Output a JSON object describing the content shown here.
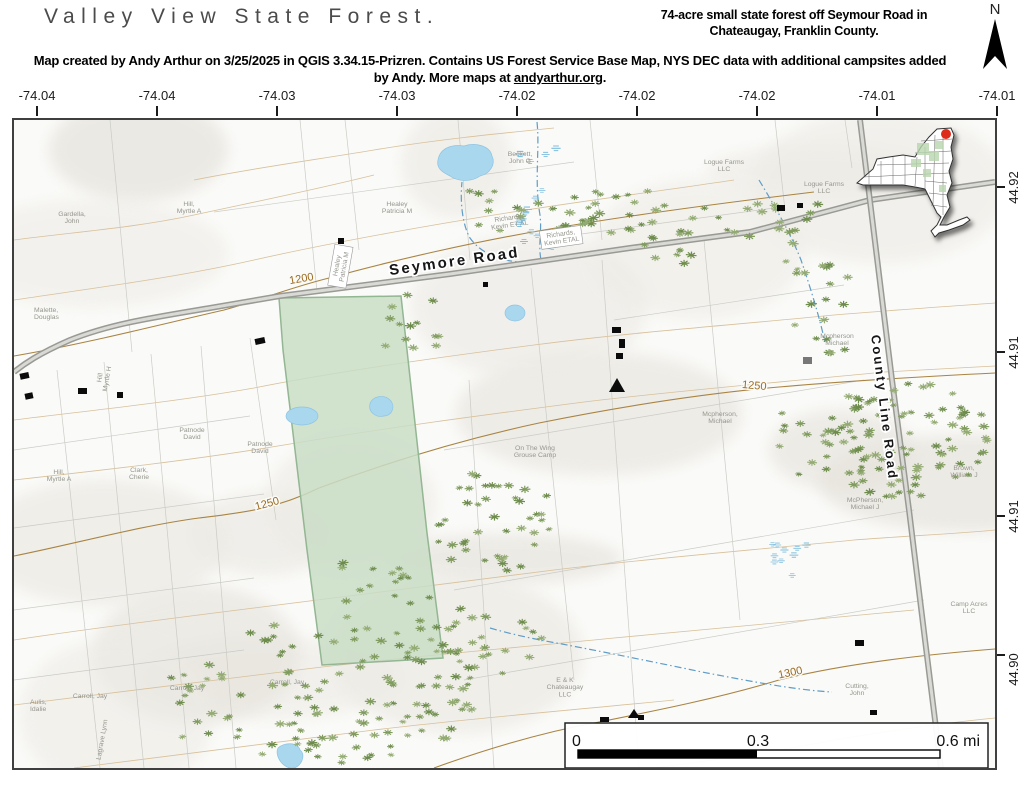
{
  "header": {
    "title": "Valley View State Forest.",
    "subtitle": "74-acre small state forest off Seymour Road in Chateaugay, Franklin County.",
    "credit_before": "Map created by Andy Arthur on 3/25/2025 in QGIS 3.34.15-Prizren. Contains US Forest Service Base Map, NYS DEC data with additional campsites added by Andy. More maps at ",
    "credit_link": "andyarthur.org",
    "credit_after": ".",
    "north_label": "N"
  },
  "axes": {
    "top": [
      "-74.04",
      "-74.04",
      "-74.03",
      "-74.03",
      "-74.02",
      "-74.02",
      "-74.02",
      "-74.01",
      "-74.01"
    ],
    "right": [
      "44.92",
      "44.91",
      "44.91",
      "44.90"
    ]
  },
  "map": {
    "road_labels": [
      {
        "text": "Seymore Road",
        "x": 441,
        "y": 146,
        "rotate": -8,
        "size": 15
      },
      {
        "text": "County Line Road",
        "x": 866,
        "y": 288,
        "rotate": 83,
        "size": 13
      }
    ],
    "contour_labels": [
      {
        "text": "1200",
        "x": 288,
        "y": 162,
        "rotate": -10
      },
      {
        "text": "1250",
        "x": 254,
        "y": 387,
        "rotate": -15
      },
      {
        "text": "1250",
        "x": 740,
        "y": 269,
        "rotate": 5
      },
      {
        "text": "1300",
        "x": 777,
        "y": 556,
        "rotate": -12
      }
    ],
    "owner_labels": [
      {
        "lines": [
          "Gardella,",
          "John"
        ],
        "x": 58,
        "y": 96
      },
      {
        "lines": [
          "Hill,",
          "Myrtle A"
        ],
        "x": 175,
        "y": 86
      },
      {
        "lines": [
          "Malette,",
          "Douglas"
        ],
        "x": 20,
        "y": 192,
        "anchor": "start"
      },
      {
        "lines": [
          "Healey",
          "Patricia M"
        ],
        "x": 383,
        "y": 86
      },
      {
        "lines": [
          "Healey",
          "Patricia M"
        ],
        "x": 325,
        "y": 146,
        "rotate": -80,
        "boxed": true
      },
      {
        "lines": [
          "Beckett,",
          "John G"
        ],
        "x": 506,
        "y": 36
      },
      {
        "lines": [
          "Logue Farms",
          "LLC"
        ],
        "x": 710,
        "y": 44
      },
      {
        "lines": [
          "Logue Farms",
          "LLC"
        ],
        "x": 810,
        "y": 66
      },
      {
        "lines": [
          "Richards,",
          "Kevin ET AL"
        ],
        "x": 495,
        "y": 100,
        "rotate": -8
      },
      {
        "lines": [
          "Richards,",
          "Kevin ETAL"
        ],
        "x": 547,
        "y": 116,
        "rotate": -8,
        "boxed": true
      },
      {
        "lines": [
          "Mcpherson",
          "Michael"
        ],
        "x": 823,
        "y": 218
      },
      {
        "lines": [
          "Mcpherson,",
          "Michael"
        ],
        "x": 706,
        "y": 296
      },
      {
        "lines": [
          "McPherson,",
          "Michael J"
        ],
        "x": 851,
        "y": 382
      },
      {
        "lines": [
          "Brown,",
          "William J"
        ],
        "x": 950,
        "y": 350
      },
      {
        "lines": [
          "Patnode",
          "David"
        ],
        "x": 178,
        "y": 312
      },
      {
        "lines": [
          "Patnode",
          "David"
        ],
        "x": 246,
        "y": 326
      },
      {
        "lines": [
          "Hill",
          "Myrtle H"
        ],
        "x": 88,
        "y": 258,
        "rotate": -80
      },
      {
        "lines": [
          "Hill,",
          "Myrtle A"
        ],
        "x": 45,
        "y": 354
      },
      {
        "lines": [
          "Clark,",
          "Cherie"
        ],
        "x": 125,
        "y": 352
      },
      {
        "lines": [
          "On The Wing",
          "Grouse Camp"
        ],
        "x": 521,
        "y": 330
      },
      {
        "lines": [
          "Carroll, Jay"
        ],
        "x": 76,
        "y": 578
      },
      {
        "lines": [
          "Carroll, Jay"
        ],
        "x": 173,
        "y": 570
      },
      {
        "lines": [
          "Carroll, Jay"
        ],
        "x": 273,
        "y": 564
      },
      {
        "lines": [
          "Aulis,",
          "Idalie"
        ],
        "x": 16,
        "y": 584,
        "anchor": "start"
      },
      {
        "lines": [
          "Lagrave Lynn"
        ],
        "x": 90,
        "y": 620,
        "rotate": -80
      },
      {
        "lines": [
          "E & K",
          "Chateaugay",
          "LLC"
        ],
        "x": 551,
        "y": 562
      },
      {
        "lines": [
          "Cutting,",
          "John"
        ],
        "x": 843,
        "y": 568
      },
      {
        "lines": [
          "Camp Acres",
          "LLC"
        ],
        "x": 955,
        "y": 486
      }
    ],
    "scalebar": {
      "start": "0",
      "mid": "0.3",
      "end": "0.6 mi"
    }
  },
  "colors": {
    "forest_fill": "#c9ddc6",
    "forest_border": "#93b693",
    "water": "#a9d7ee",
    "stream": "#5f9dc8",
    "contour_dark": "#a98443",
    "contour_light": "#d4bb92",
    "road": "#a3a39e",
    "owner_label": "#96968e",
    "tree_green": "#7f9b5d",
    "red_dot": "#dd2b1c"
  }
}
